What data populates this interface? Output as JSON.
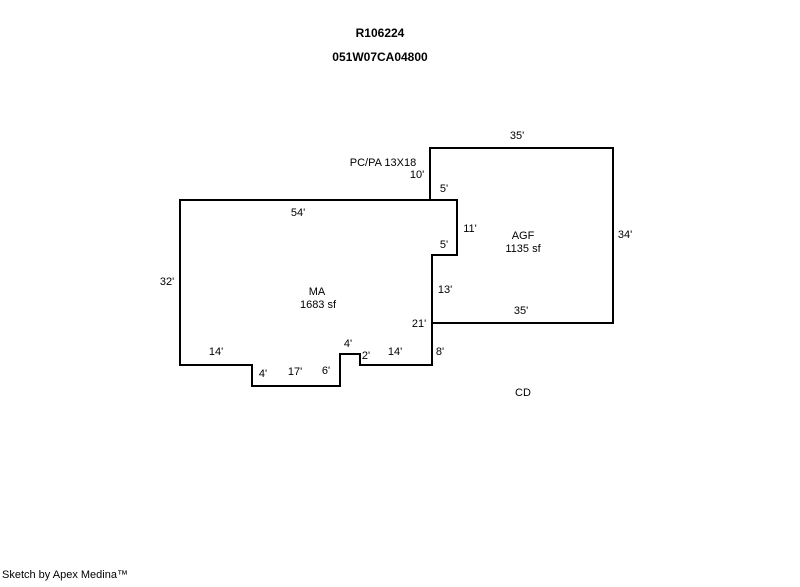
{
  "header": {
    "record_id": "R106224",
    "parcel_id": "051W07CA04800"
  },
  "sketch": {
    "structures": {
      "ma": {
        "code": "MA",
        "area": "1683 sf"
      },
      "agf": {
        "code": "AGF",
        "area": "1135 sf"
      }
    },
    "annotations": {
      "pc_pa": "PC/PA 13X18",
      "cd": "CD"
    },
    "dims": {
      "agf_top": "35'",
      "agf_left_upper": "10'",
      "agf_attach_top": "5'",
      "agf_notch_right": "11'",
      "agf_notch_bottom": "5'",
      "agf_right": "34'",
      "agf_left_lower": "13'",
      "agf_bottom": "35'",
      "ma_top": "54'",
      "ma_left": "32'",
      "ma_right_total": "21'",
      "ma_right_lower": "8'",
      "ma_bottom_left": "14'",
      "ma_bottom_right": "14'",
      "ma_notch_left": "4'",
      "ma_notch_bottom": "17'",
      "ma_tab_left": "6'",
      "ma_tab_top": "4'",
      "ma_tab_right": "2'"
    }
  },
  "footer": {
    "credit": "Sketch by Apex Medina™"
  }
}
